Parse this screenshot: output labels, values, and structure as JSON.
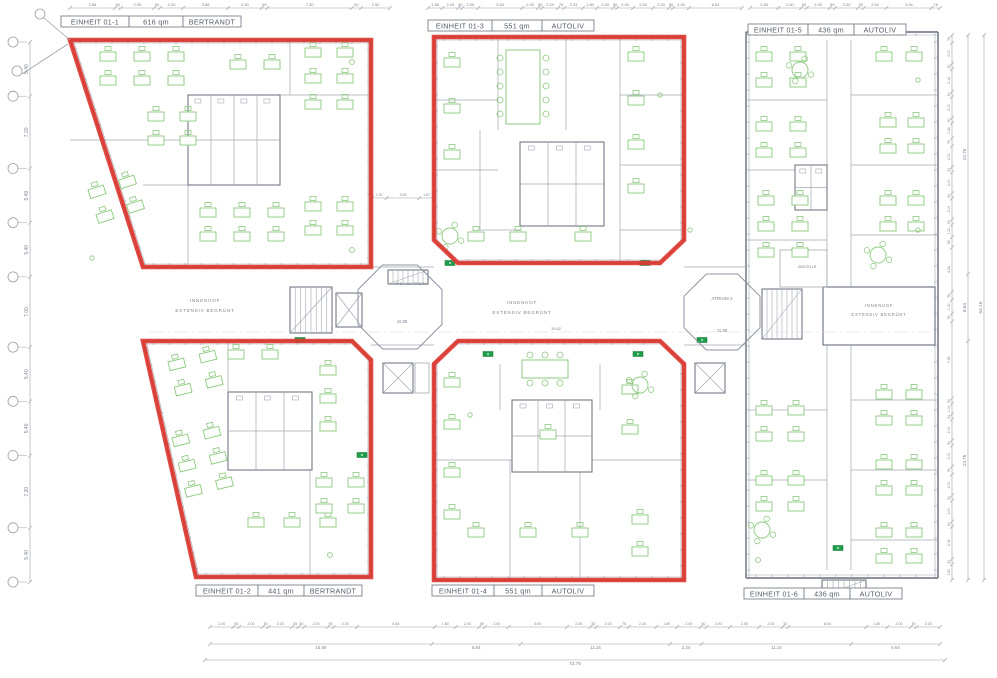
{
  "units": [
    {
      "name": "EINHEIT 01-1",
      "area": "616 qm",
      "tenant": "BERTRANDT"
    },
    {
      "name": "EINHEIT 01-2",
      "area": "441 qm",
      "tenant": "BERTRANDT"
    },
    {
      "name": "EINHEIT 01-3",
      "area": "551 qm",
      "tenant": "AUTOLIV"
    },
    {
      "name": "EINHEIT 01-4",
      "area": "551 qm",
      "tenant": "AUTOLIV"
    },
    {
      "name": "EINHEIT 01-5",
      "area": "436 qm",
      "tenant": "AUTOLIV"
    },
    {
      "name": "EINHEIT 01-6",
      "area": "436 qm",
      "tenant": "AUTOLIV"
    }
  ],
  "courtyards": {
    "left": {
      "line1": "INNENHOF",
      "line2": "EXTENSIV BEGRÜNT"
    },
    "middle": {
      "line1": "INNENHOF",
      "line2": "EXTENSIV BEGRÜNT",
      "width_dim": "19.82"
    },
    "right": {
      "line1": "INNENHOF",
      "line2": "EXTENSIV BEGRÜNT"
    }
  },
  "atriums": {
    "atrium1": {
      "note": "KFB 4.08 ATRIUM 1",
      "dim": "10.88"
    },
    "atrium2": {
      "label": "ATRIUM 2",
      "dim": "11.98"
    }
  },
  "rooms": {
    "storage": "ABSTELLR."
  },
  "colors": {
    "unit_outline_red": "#dd3a31",
    "furniture_green": "#8cc87f",
    "exit_sign_green": "#1e9e4a",
    "wall_gray": "#666d79",
    "dimension_gray": "#7b8290"
  },
  "dims": {
    "left_chain": [
      "5.40",
      "7.20",
      "5.40",
      "5.40",
      "7.00",
      "5.40",
      "5.40",
      "7.20",
      "5.40"
    ],
    "top_left": [
      "3.88",
      "50",
      "2.90",
      "50",
      "2.00",
      "3.88",
      "2.90",
      "50",
      "7.30",
      "80",
      "2.50"
    ],
    "top_mid": [
      "1.80",
      "2.00",
      "50",
      "2.00",
      "5.50",
      "2.00",
      "50",
      "2.00",
      "76",
      "2.34",
      "1.80",
      "2.00",
      "50",
      "2.00",
      "2.50",
      "2.00",
      "50",
      "2.00",
      "6.64"
    ],
    "top_right": [
      "2.50",
      "2.00",
      "50",
      "2.00",
      "50",
      "2.00",
      "50",
      "2.00",
      "3.96",
      "76"
    ],
    "inner_mid": [
      "1.57",
      "3.50",
      "1.57"
    ],
    "right_detail": [
      "76",
      "2.00",
      "50",
      "2.16",
      "50",
      "2.00",
      "50",
      "1.44",
      "76",
      "2.00",
      "50",
      "2.00",
      "50",
      "2.00",
      "50",
      "1.20",
      "98",
      "4.24",
      "76",
      "1.30",
      "76",
      "7.36",
      "50",
      "1.00",
      "50",
      "2.00",
      "50",
      "2.00",
      "76",
      "2.00",
      "50",
      "2.00",
      "50",
      "3.08",
      "50",
      "1.50"
    ],
    "right_totals": [
      "23.76",
      "6.64",
      "23.76"
    ],
    "right_grand": "54.16",
    "bottom_detail": [
      "2.00",
      "50",
      "2.00",
      "50",
      "2.00",
      "55",
      "50",
      "2.00",
      "50",
      "2.00",
      "6.64",
      "1.80",
      "2.00",
      "50",
      "2.00",
      "5.00",
      "2.00",
      "50",
      "2.00",
      "76",
      "2.34",
      "1.80",
      "2.00",
      "50",
      "2.00",
      "2.50",
      "2.00",
      "50",
      "6.64",
      "1.80",
      "2.00",
      "50",
      "2.00"
    ],
    "bottom_subtotals": [
      "16.56",
      "6.64",
      "11.16",
      "2.34",
      "11.16",
      "6.64"
    ],
    "bottom_total": "73.76"
  }
}
